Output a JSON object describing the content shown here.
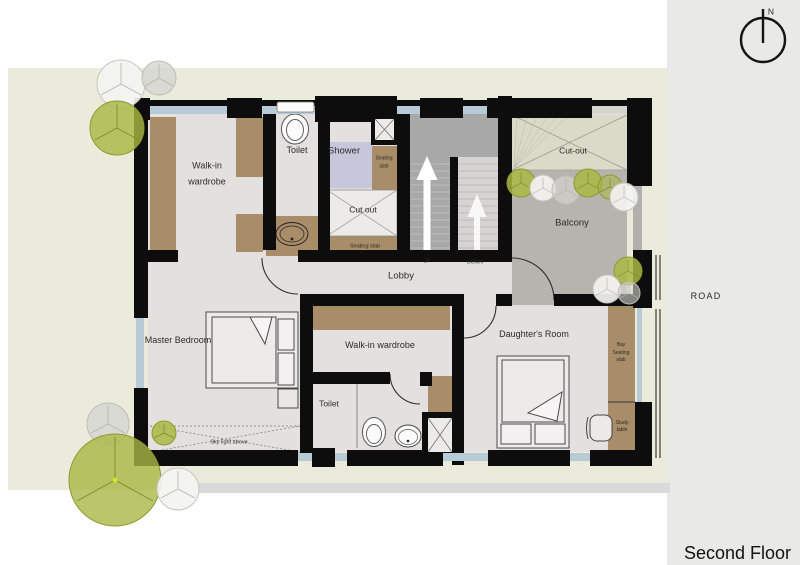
{
  "meta": {
    "floor_title": "Second Floor",
    "road": "ROAD",
    "north": "N"
  },
  "rooms": {
    "wardrobe1": "Walk-in\nwardrobe",
    "toilet1": "Toilet",
    "shower": "Shower",
    "seating_slab_shower": "Seating\nslab",
    "cut_out_small": "Cut out",
    "seating_slab_cutout": "Seating slab",
    "stairs_up": "UP",
    "stairs_down": "DOWN",
    "lobby": "Lobby",
    "cut_out_large": "Cut-out",
    "balcony": "Balcony",
    "master_bedroom": "Master Bedroom",
    "wardrobe2": "Walk-in wardrobe",
    "daughters_room": "Daughter's Room",
    "toilet2": "Toilet",
    "bay_seating_slab": "Bay\nSeating\nslab",
    "study_table": "Study\ntable",
    "skylight": "Sky light above"
  },
  "colors": {
    "wall": "#0d0d0d",
    "sheet": "#ebebdc",
    "floor": "#e4e0e0",
    "wood_brown": "#a98c68",
    "shower_pan": "#c6c7da",
    "balcony_gray": "#b7b4af",
    "cutout_green": "#d9dac7",
    "stairs_dark": "#a8a8a8",
    "stairs_light": "#d7d3d3",
    "window_glass": "#b6cbd5",
    "road_bg": "#e9e9e7",
    "tree_green": "#a9b843"
  }
}
